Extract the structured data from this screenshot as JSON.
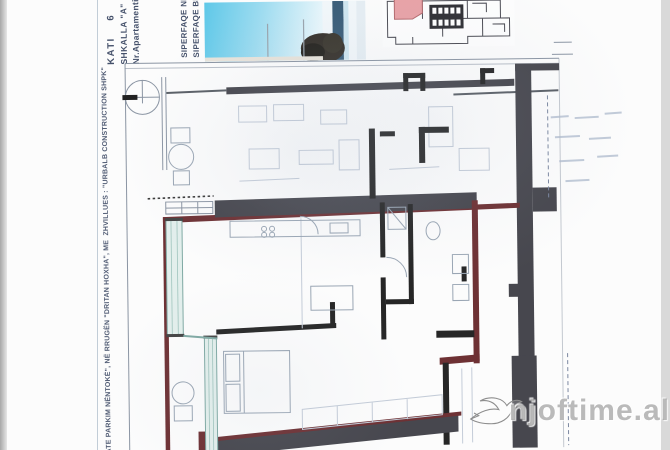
{
  "colors": {
    "wall": "#47474e",
    "outline": "#6e3134",
    "ink": "#44506a",
    "glazing_fill": "#e3efec",
    "glazing_stroke": "#7fa9a3",
    "unit_pink": "#e9a2a6",
    "sky": "#5fc8e8",
    "watermark": "#8d8d8d"
  },
  "title_block": {
    "kati": "KATI    6",
    "shkalla": "SHKALLA \"A\"",
    "apartment_no": "Nr.Apartamentit  D",
    "area_net": "SIPERFAQE NETO",
    "area_gross": "SIPERFAQE BRUTO"
  },
  "side_note": "KATE PARKIM NËNTOKË\", NË RRUGËN \"DRITAN HOXHA\", ME  ZHVILLUES : \"URBALB CONSTRUCTION SHPK\"",
  "watermark": {
    "site": "njoftime.al"
  }
}
